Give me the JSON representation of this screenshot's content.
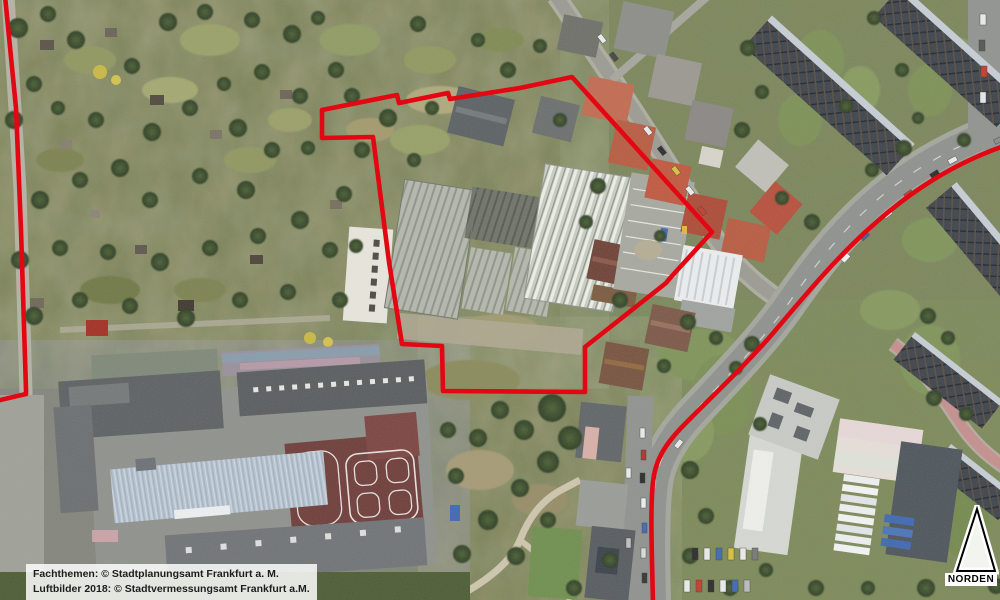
{
  "map": {
    "kind": "aerial-orthophoto",
    "boundary_color": "#e30613",
    "city": "Frankfurt am Main"
  },
  "attribution": {
    "line1": "Fachthemen: © Stadtplanungsamt Frankfurt a. M.",
    "line2": "Luftbilder 2018: © Stadtvermessungsamt Frankfurt a.M."
  },
  "north_arrow": {
    "label": "NORDEN"
  }
}
